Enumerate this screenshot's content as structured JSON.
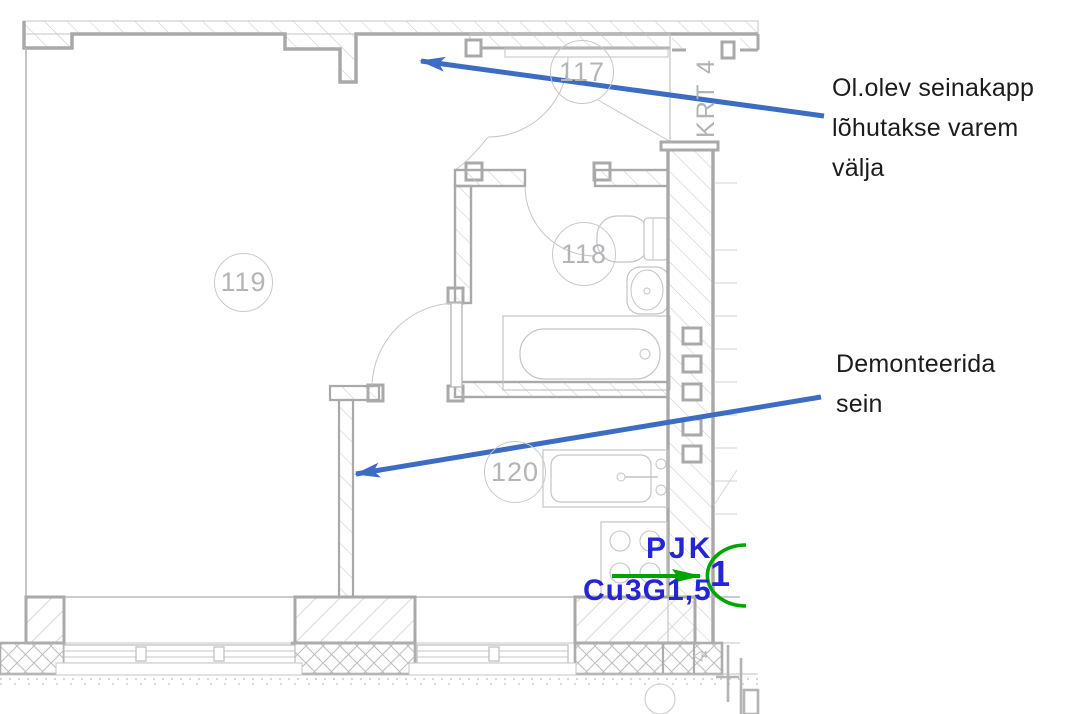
{
  "plan": {
    "room_labels": [
      {
        "id": "117",
        "label": "117"
      },
      {
        "id": "118",
        "label": "118"
      },
      {
        "id": "119",
        "label": "119"
      },
      {
        "id": "120",
        "label": "120"
      }
    ],
    "corridor_label": "KRT 4",
    "dimension_mark": "4",
    "electrical": {
      "device_label": "PJK",
      "cable_label": "Cu3G1,5",
      "group_number": "1"
    }
  },
  "annotations": {
    "wall_cabinet_note": {
      "lines": [
        "Ol.olev seinakapp",
        "lõhutakse varem",
        "välja"
      ]
    },
    "demolish_wall_note": {
      "lines": [
        "Demonteerida",
        "sein"
      ]
    }
  },
  "colors": {
    "annotation_arrow_blue": "#3d6cc3",
    "electrical_text_blue": "#2525d4",
    "electrical_green": "#00a400",
    "plan_thin_line": "#bcbcbc",
    "plan_wall_line": "#a9a9a9",
    "room_label_gray": "#b3b5b9"
  }
}
